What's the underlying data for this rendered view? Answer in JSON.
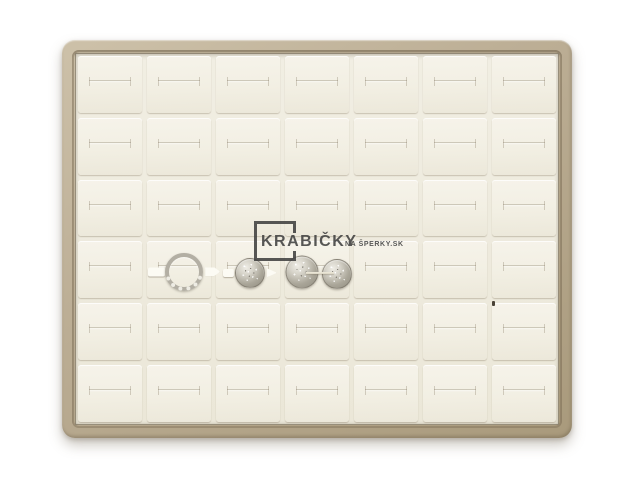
{
  "meta": {
    "type": "product-photo",
    "subject": "Jewelry ring display tray with 42 slots holding 4 silver rings",
    "background_color": "#ffffff"
  },
  "watermark": {
    "brand": "KRABIČKY",
    "suffix": "NA ŠPERKY.SK",
    "color": "#3b3b3b"
  },
  "tray": {
    "frame_color": "#b6a88f",
    "frame_highlight": "#cdc1a9",
    "pad_color": "#f3f0e5",
    "gap_color": "#efece1",
    "slit_color": "#d5cfbd",
    "columns": 7,
    "rows": 6,
    "slot_count": 42
  },
  "rings": [
    {
      "id": "ring-open-band",
      "description": "large open silver ring, profile view, pave lower band",
      "row": 4,
      "col": 2,
      "cx": 0.58,
      "cy": 0.53,
      "size": 38,
      "style": "profile",
      "tabs": "large"
    },
    {
      "id": "ring-pave-1",
      "description": "round pave silver ring, face view",
      "row": 4,
      "col": 3,
      "cx": 0.53,
      "cy": 0.55,
      "size": 30,
      "style": "face",
      "tabs": "small"
    },
    {
      "id": "ring-pave-2",
      "description": "round pave silver ring, face view",
      "row": 4,
      "col": 4,
      "cx": 0.27,
      "cy": 0.54,
      "size": 33,
      "style": "face",
      "tabs": "none"
    },
    {
      "id": "ring-pave-3",
      "description": "round pave silver ring, face view",
      "row": 4,
      "col": 4,
      "cx": 0.82,
      "cy": 0.57,
      "size": 30,
      "style": "face",
      "tabs": "none"
    }
  ],
  "marks": [
    {
      "id": "holder-seam",
      "kind": "seam",
      "row": 4,
      "col": 4,
      "cx": 0.55,
      "cy": 0.55,
      "w": 28,
      "h": 2
    },
    {
      "id": "dark-speck",
      "kind": "speck",
      "row": 5,
      "col": 7,
      "cx": 0.02,
      "cy": 0.0,
      "w": 3,
      "h": 5
    }
  ]
}
